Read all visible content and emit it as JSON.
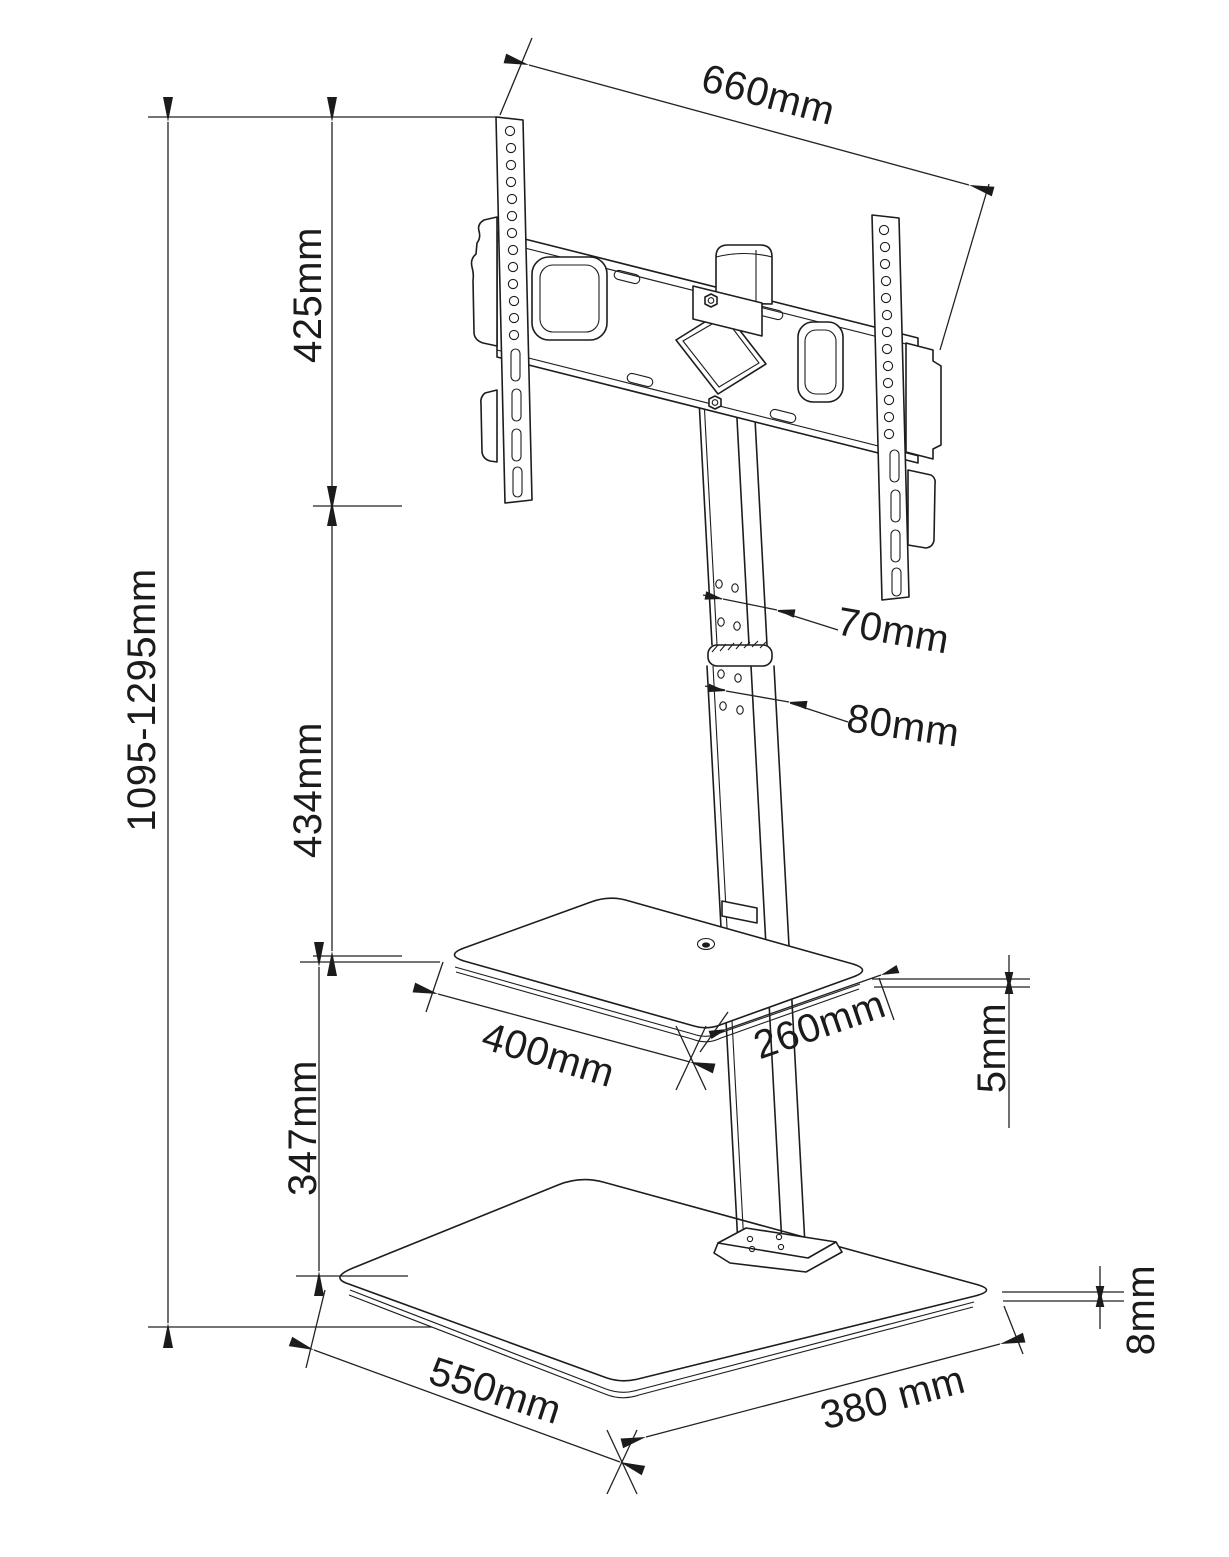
{
  "diagram": {
    "kind": "technical dimension drawing",
    "subject": "floor TV stand with mount bracket, glass shelf and glass base",
    "units": "mm",
    "colors": {
      "line": "#1d1d1d",
      "background": "#ffffff"
    }
  },
  "dims": {
    "bracket_width": "660mm",
    "bracket_height": "425mm",
    "overall_height": "1095-1295mm",
    "bracket_to_shelf": "434mm",
    "upper_pole_width": "70mm",
    "lower_pole_width": "80mm",
    "shelf_width": "400mm",
    "shelf_depth": "260mm",
    "shelf_thickness": "5mm",
    "shelf_to_base": "347mm",
    "base_width": "550mm",
    "base_depth": "380 mm",
    "base_thickness": "8mm"
  }
}
